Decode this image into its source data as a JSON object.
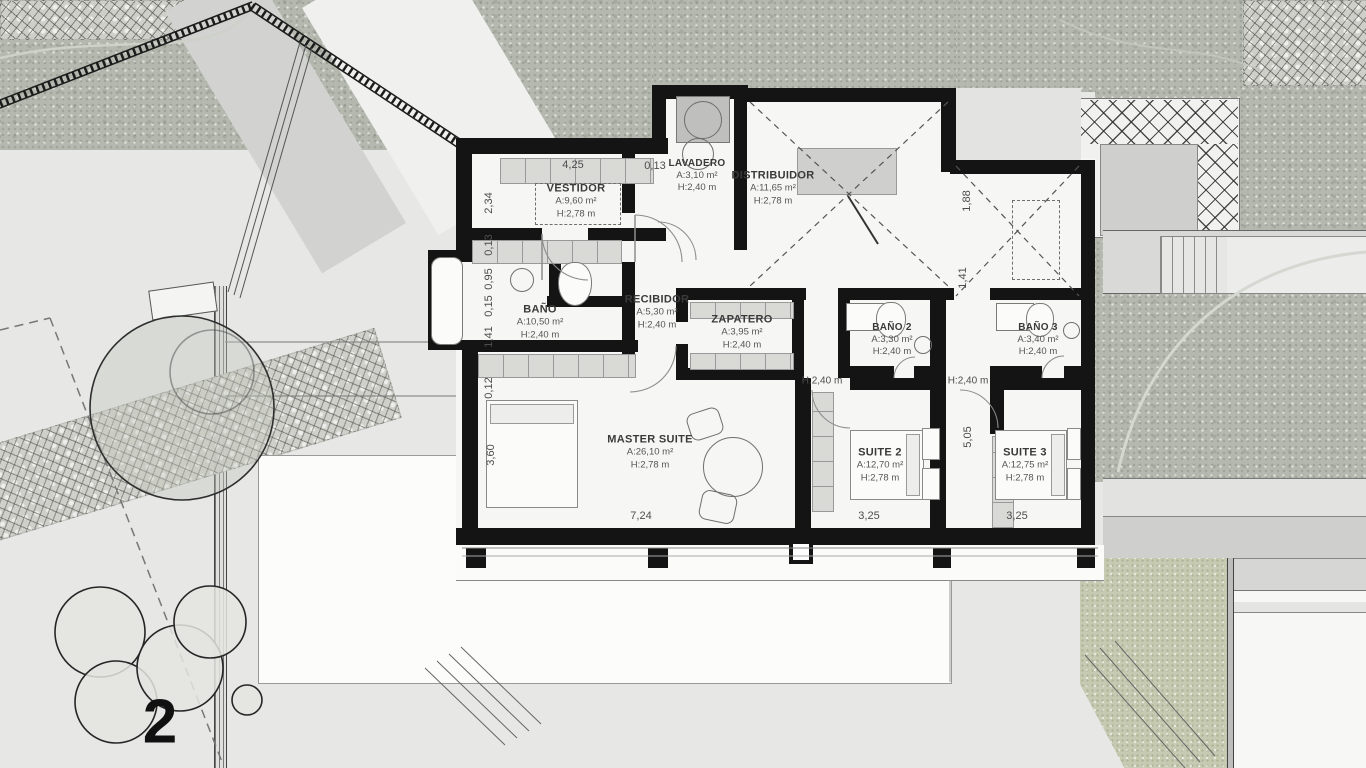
{
  "plan": {
    "floor_number": "2",
    "rooms": [
      {
        "name": "VESTIDOR",
        "area": "A:9,60 m²",
        "height": "H:2,78 m"
      },
      {
        "name": "LAVADERO",
        "area": "A:3,10 m²",
        "height": "H:2,40 m"
      },
      {
        "name": "DISTRIBUIDOR",
        "area": "A:11,65 m²",
        "height": "H:2,78 m"
      },
      {
        "name": "BAÑO",
        "area": "A:10,50 m²",
        "height": "H:2,40 m"
      },
      {
        "name": "RECIBIDOR",
        "area": "A:5,30 m²",
        "height": "H:2,40 m"
      },
      {
        "name": "ZAPATERO",
        "area": "A:3,95 m²",
        "height": "H:2,40 m"
      },
      {
        "name": "BAÑO 2",
        "area": "A:3,30 m²",
        "height": "H:2,40 m"
      },
      {
        "name": "BAÑO 3",
        "area": "A:3,40 m²",
        "height": "H:2,40 m"
      },
      {
        "name": "MASTER SUITE",
        "area": "A:26,10 m²",
        "height": "H:2,78 m"
      },
      {
        "name": "SUITE 2",
        "area": "A:12,70 m²",
        "height": "H:2,78 m"
      },
      {
        "name": "SUITE 3",
        "area": "A:12,75 m²",
        "height": "H:2,78 m"
      }
    ],
    "corridor_labels": [
      "H:2,40 m",
      "H:2,40 m"
    ],
    "dimensions": {
      "top": [
        "4,25",
        "0,13"
      ],
      "left": [
        "2,34",
        "0,13",
        "0,95",
        "0,15",
        "1,41",
        "0,12",
        "3,60"
      ],
      "right": [
        "1,88",
        "1,41",
        "5,05"
      ],
      "bottom": [
        "7,24",
        "3,25",
        "3,25"
      ]
    }
  },
  "colors": {
    "wall": "#141414",
    "terrain": "#b4b8ae",
    "grass": "#c7cab2",
    "paper": "#e9e9e7",
    "room_fill": "#f6f6f4"
  }
}
